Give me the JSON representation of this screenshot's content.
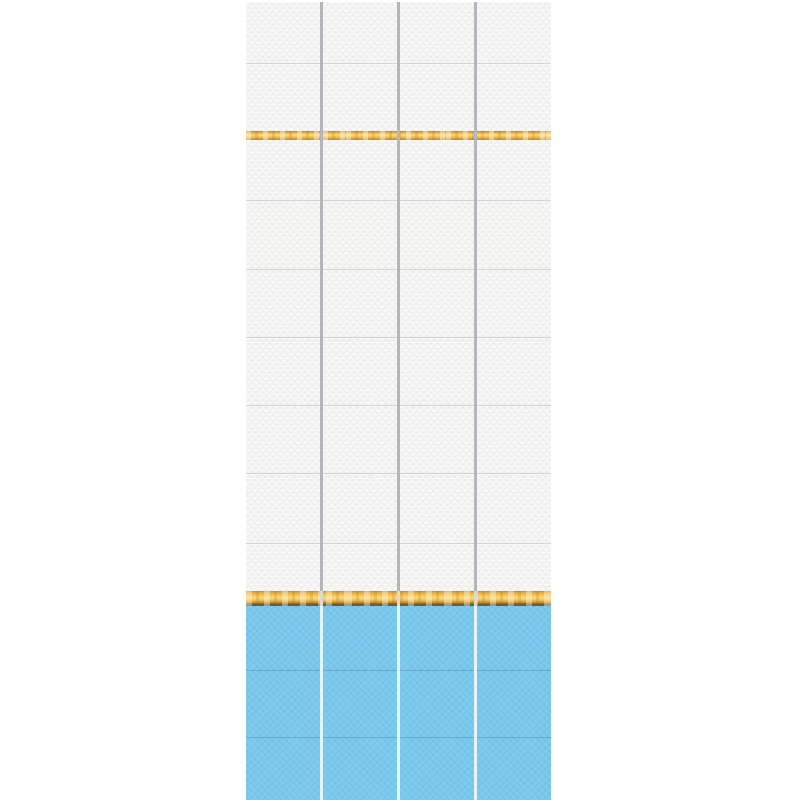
{
  "scene": {
    "description": "Product photo of decorative PVC wall panels: four vertical strips of white textured tiles with two golden wood-grain trim stripes and sky-blue tiles across the bottom",
    "background_color": "#ffffff"
  },
  "layout": {
    "panel_count": 4,
    "block_left_px": 246,
    "block_top_px": 2,
    "block_width_px": 305,
    "block_height_px": 798,
    "divider_width_px": 3,
    "divider_zones": {
      "white_zone_end_px": 589,
      "gold_zone_end_px": 604
    },
    "bands": [
      {
        "type": "white",
        "height": 61,
        "seam": false
      },
      {
        "type": "white",
        "height": 68,
        "seam": true
      },
      {
        "type": "gold",
        "height": 9,
        "seam": false
      },
      {
        "type": "white",
        "height": 60,
        "seam": false
      },
      {
        "type": "white",
        "height": 69,
        "seam": true
      },
      {
        "type": "white",
        "height": 68,
        "seam": true
      },
      {
        "type": "white",
        "height": 68,
        "seam": true
      },
      {
        "type": "white",
        "height": 68,
        "seam": true
      },
      {
        "type": "white",
        "height": 70,
        "seam": true
      },
      {
        "type": "white",
        "height": 48,
        "seam": true
      },
      {
        "type": "gold-major",
        "height": 15,
        "seam": false
      },
      {
        "type": "blue",
        "height": 64,
        "seam": false
      },
      {
        "type": "blue",
        "height": 67,
        "seam": true
      },
      {
        "type": "blue",
        "height": 63,
        "seam": true
      }
    ]
  },
  "colors": {
    "white_tile": "#f5f5f4",
    "white_tile_shadow": "#e8e8e7",
    "blue_tile": "#7ecbee",
    "blue_tile_shadow": "#6cbfe5",
    "gold_highlight": "#f9d87e",
    "gold_base": "#e9b348",
    "gold_dark": "#c08a2b",
    "gold_bottom_shadow": "#6e5c36",
    "divider_white_zone": "#b3b6bb",
    "divider_gold_zone": "#dcd9d2",
    "divider_blue_zone": "#e6f4fb",
    "seam_white_zone": "#d2d3d4",
    "seam_blue_zone": "#4f96c0"
  }
}
